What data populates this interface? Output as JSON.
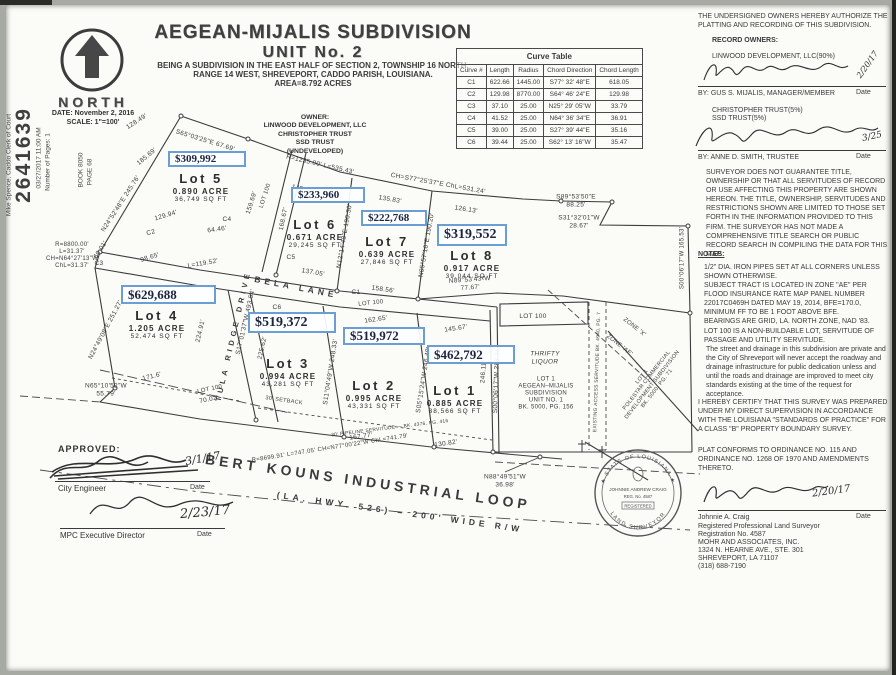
{
  "title": {
    "line1": "AEGEAN-MIJALIS SUBDIVISION",
    "line2": "UNIT No. 2",
    "line3": "BEING A SUBDIVISION IN THE EAST HALF OF SECTION 2, TOWNSHIP 16 NORTH,",
    "line4": "RANGE 14 WEST, SHREVEPORT, CADDO PARISH, LOUISIANA.",
    "line5": "AREA=8.792 ACRES"
  },
  "north": {
    "label": "NORTH",
    "date": "DATE: November 2, 2016",
    "scale": "SCALE: 1\"=100'"
  },
  "stamp": {
    "clerk": "Mike Spence, Caddo Clerk of Court",
    "number": "2641639",
    "filed": "03/27/2017 11:00 AM",
    "pages": "Number of Pages: 1",
    "book": "BOOK  8050",
    "page": "PAGE  68"
  },
  "owner_block": {
    "l1": "OWNER:",
    "l2": "LINWOOD DEVELOPMENT, LLC",
    "l3": "CHRISTOPHER TRUST",
    "l4": "SSD TRUST",
    "l5": "(UNDEVELOPED)"
  },
  "curve_table": {
    "title": "Curve Table",
    "headers": [
      "Curve #",
      "Length",
      "Radius",
      "Chord Direction",
      "Chord Length"
    ],
    "rows": [
      [
        "C1",
        "622.66",
        "1445.00",
        "S77° 32' 48\"E",
        "618.05"
      ],
      [
        "C2",
        "129.98",
        "8770.00",
        "S64° 46' 24\"E",
        "129.98"
      ],
      [
        "C3",
        "37.10",
        "25.00",
        "N25° 29' 05\"W",
        "33.79"
      ],
      [
        "C4",
        "41.52",
        "25.00",
        "N64° 36' 34\"E",
        "36.91"
      ],
      [
        "C5",
        "39.00",
        "25.00",
        "S27° 39' 44\"E",
        "35.16"
      ],
      [
        "C6",
        "39.44",
        "25.00",
        "S62° 13' 16\"W",
        "35.47"
      ]
    ]
  },
  "right_panel": {
    "authorize": "THE UNDERSIGNED OWNERS HEREBY AUTHORIZE THE PLATTING AND RECORDING OF THIS SUBDIVISION.",
    "record_owners": "RECORD OWNERS:",
    "owner1": "LINWOOD DEVELOPMENT, LLC(90%)",
    "by1": "BY: GUS S. MIJALIS, MANAGER/MEMBER",
    "date1": "2/20/17",
    "owner2a": "CHRISTOPHER TRUST(5%)",
    "owner2b": "SSD TRUST(5%)",
    "by2": "BY: ANNE D. SMITH, TRUSTEE",
    "date2": "3/25",
    "date_label": "Date",
    "disclaimer": "SURVEYOR DOES NOT GUARANTEE TITLE, OWNERSHIP OR THAT ALL SERVITUDES OF RECORD OR USE AFFECTING THIS PROPERTY ARE SHOWN HEREON. THE TITLE, OWNERSHIP, SERVITUDES AND RESTRICTIONS SHOWN ARE LIMITED TO THOSE SET FORTH IN THE INFORMATION PROVIDED TO THIS FIRM. THE SURVEYOR HAS NOT MADE A COMPREHENSIVE TITLE SEARCH OR PUBLIC RECORD SEARCH IN COMPILING THE DATA FOR THIS MAP.",
    "notes_heading": "NOTES:",
    "notes": [
      "1/2\" DIA. IRON PIPES SET AT ALL CORNERS UNLESS SHOWN OTHERWISE.",
      "SUBJECT TRACT IS LOCATED IN ZONE \"AE\" PER FLOOD INSURANCE RATE MAP PANEL NUMBER 22017C0469H DATED MAY 19, 2014, BFE=170.0, MINIMUM FF TO BE 1 FOOT ABOVE BFE.",
      "BEARINGS ARE GRID, LA. NORTH ZONE, NAD '83.",
      "LOT 100 IS A NON-BUILDABLE LOT, SERVITUDE OF PASSAGE AND UTILITY SERVITUDE.",
      "The street and drainage in this subdivision are private and the City of Shreveport will never accept the roadway and drainage infrastructure for public dedication unless and until the roads and drainage are improved to meet city standards existing at the time of the request for acceptance."
    ],
    "certify": "I HEREBY CERTIFY THAT THIS SURVEY WAS PREPARED UNDER MY DIRECT SUPERVISION IN ACCORDANCE WITH THE LOUISIANA \"STANDARDS OF PRACTICE\" FOR A CLASS \"B\" PROPERTY BOUNDARY SURVEY.",
    "conforms": "PLAT CONFORMS TO ORDINANCE NO. 115 AND ORDINANCE NO. 1268 OF 1970 AND AMENDMENTS THERETO.",
    "surveyor_name": "Johnnie A. Craig",
    "surveyor_date": "2/20/17",
    "cred1": "Registered Professional Land Surveyor",
    "cred2": "Registration No. 4587",
    "cred3": "MOHR AND ASSOCIATES, INC.",
    "cred4": "1324 N. HEARNE AVE., STE. 301",
    "cred5": "SHREVEPORT, LA 71107",
    "cred6": "(318) 688-7190"
  },
  "approvals": {
    "heading": "APPROVED:",
    "rows": [
      {
        "role": "City Engineer",
        "date": "3/1/17",
        "date_label": "Date"
      },
      {
        "role": "MPC Executive Director",
        "date": "2/23/17",
        "date_label": "Date"
      }
    ]
  },
  "seal": {
    "top": "★ STATE OF LOUISIANA ★",
    "bottom": "LAND SURVEYOR",
    "name": "JOHNNIE ANDREW CRAIG",
    "reg": "REG. No. 4587",
    "registered": "REGISTERED"
  },
  "plat": {
    "lots": [
      {
        "name": "Lot 5",
        "acre": "0.890 ACRE",
        "sqft": "36,749 SQ FT",
        "price": "$309,992",
        "lx": 201,
        "ly": 171,
        "bx": 168,
        "by": 151,
        "bw": 78,
        "bh": 16,
        "fs": 11
      },
      {
        "name": "Lot 6",
        "acre": "0.671 ACRE",
        "sqft": "29,245 SQ FT",
        "price": "$233,960",
        "lx": 315,
        "ly": 217,
        "bx": 291,
        "by": 187,
        "bw": 74,
        "bh": 16,
        "fs": 11
      },
      {
        "name": "Lot 7",
        "acre": "0.639 ACRE",
        "sqft": "27,846 SQ FT",
        "price": "$222,768",
        "lx": 387,
        "ly": 234,
        "bx": 361,
        "by": 210,
        "bw": 66,
        "bh": 16,
        "fs": 11
      },
      {
        "name": "Lot 8",
        "acre": "0.917 ACRE",
        "sqft": "39,044 SQ FT",
        "price": "$319,552",
        "lx": 472,
        "ly": 248,
        "bx": 437,
        "by": 224,
        "bw": 70,
        "bh": 22,
        "fs": 14
      },
      {
        "name": "Lot 4",
        "acre": "1.205 ACRE",
        "sqft": "52,474 SQ FT",
        "price": "$629,688",
        "lx": 157,
        "ly": 308,
        "bx": 121,
        "by": 285,
        "bw": 95,
        "bh": 19,
        "fs": 13
      },
      {
        "name": "Lot 3",
        "acre": "0.994 ACRE",
        "sqft": "43,281 SQ FT",
        "price": "$519,372",
        "lx": 288,
        "ly": 356,
        "bx": 248,
        "by": 312,
        "bw": 88,
        "bh": 21,
        "fs": 14
      },
      {
        "name": "Lot 2",
        "acre": "0.995 ACRE",
        "sqft": "43,331 SQ FT",
        "price": "$519,972",
        "lx": 374,
        "ly": 378,
        "bx": 343,
        "by": 327,
        "bw": 82,
        "bh": 18,
        "fs": 13
      },
      {
        "name": "Lot 1",
        "acre": "0.885 ACRE",
        "sqft": "38,566 SQ FT",
        "price": "$462,792",
        "lx": 455,
        "ly": 383,
        "bx": 427,
        "by": 345,
        "bw": 88,
        "bh": 19,
        "fs": 13
      }
    ],
    "labels": [
      {
        "t": "S65°03'25\"E  67.69'",
        "x": 205,
        "y": 141,
        "r": 17
      },
      {
        "t": "128.49'",
        "x": 137,
        "y": 122,
        "r": -33
      },
      {
        "t": "185.69'",
        "x": 147,
        "y": 157,
        "r": -40
      },
      {
        "t": "N24°52'48\"E  245.76'",
        "x": 121,
        "y": 204,
        "r": -57
      },
      {
        "t": "129.94'",
        "x": 166,
        "y": 216,
        "r": -17
      },
      {
        "t": "C2",
        "x": 151,
        "y": 233,
        "r": -15
      },
      {
        "t": "64.46'",
        "x": 217,
        "y": 230,
        "r": -8
      },
      {
        "t": "C4",
        "x": 227,
        "y": 220
      },
      {
        "t": "159.69'",
        "x": 252,
        "y": 203,
        "r": -72
      },
      {
        "t": "LOT 100",
        "x": 266,
        "y": 196,
        "r": -72,
        "s": 6
      },
      {
        "t": "60.01'",
        "x": 101,
        "y": 250,
        "r": -57
      },
      {
        "t": "98.65'",
        "x": 150,
        "y": 258,
        "r": -17
      },
      {
        "t": "L=119.52'",
        "x": 203,
        "y": 264,
        "r": -10
      },
      {
        "t": "R=1235.00'  L=535.43'",
        "x": 320,
        "y": 165,
        "r": 13
      },
      {
        "t": "CH=S77°25'37\"E  ChL=531.24'",
        "x": 438,
        "y": 184,
        "r": 10
      },
      {
        "t": "145.36'",
        "x": 303,
        "y": 190,
        "r": 13
      },
      {
        "t": "135.83'",
        "x": 390,
        "y": 200,
        "r": 10
      },
      {
        "t": "126.13'",
        "x": 466,
        "y": 210,
        "r": 9
      },
      {
        "t": "168.67'",
        "x": 284,
        "y": 219,
        "r": -78
      },
      {
        "t": "N12°14'48\"E  190.30'",
        "x": 345,
        "y": 236,
        "r": -80
      },
      {
        "t": "N05°57'16\"E  190.20'",
        "x": 427,
        "y": 245,
        "r": -80
      },
      {
        "t": "C5",
        "x": 291,
        "y": 258
      },
      {
        "t": "137.05'",
        "x": 313,
        "y": 273,
        "r": 10
      },
      {
        "t": "158.56'",
        "x": 383,
        "y": 290,
        "r": 8
      },
      {
        "t": "C1",
        "x": 356,
        "y": 293
      },
      {
        "t": "S89°53'50\"E\n88.25'",
        "x": 576,
        "y": 201
      },
      {
        "t": "S31°32'01\"W\n28.67'",
        "x": 579,
        "y": 222
      },
      {
        "t": "S00°06'17\"W  165.53'",
        "x": 683,
        "y": 258,
        "r": -90,
        "s": 6
      },
      {
        "t": "N89°53'43\"W\n77.67'",
        "x": 470,
        "y": 284,
        "r": -4
      },
      {
        "t": "R=8800.00'\nL=31.37'\nCH=N64°27'13\"W\nChL=31.37'",
        "x": 72,
        "y": 256,
        "s": 6
      },
      {
        "t": "C3",
        "x": 99,
        "y": 264
      },
      {
        "t": "N24°49'08\"E  251.27'",
        "x": 106,
        "y": 330,
        "r": -62
      },
      {
        "t": "224.91'",
        "x": 201,
        "y": 331,
        "r": -77
      },
      {
        "t": "S17°01'37\"W  493.54'",
        "x": 246,
        "y": 322,
        "r": -77
      },
      {
        "t": "225.62'",
        "x": 263,
        "y": 348,
        "r": -77
      },
      {
        "t": "C6",
        "x": 277,
        "y": 308
      },
      {
        "t": "171.6'",
        "x": 152,
        "y": 377,
        "r": -14
      },
      {
        "t": "N65°10'52\"W\n55.79'",
        "x": 106,
        "y": 390
      },
      {
        "t": "LOT 100",
        "x": 210,
        "y": 390,
        "r": -12,
        "s": 6
      },
      {
        "t": "70.02'",
        "x": 209,
        "y": 400,
        "r": -12
      },
      {
        "t": "30' SETBACK",
        "x": 284,
        "y": 401,
        "r": 8,
        "s": 5.5
      },
      {
        "t": "LOT 100",
        "x": 371,
        "y": 304,
        "r": -6,
        "s": 6
      },
      {
        "t": "162.65'",
        "x": 376,
        "y": 320,
        "r": -8
      },
      {
        "t": "145.67'",
        "x": 456,
        "y": 329,
        "r": -8
      },
      {
        "t": "S11°04'49\"W  248.33'",
        "x": 331,
        "y": 372,
        "r": -81
      },
      {
        "t": "S05°15'24\"W  246.48'",
        "x": 424,
        "y": 380,
        "r": -81
      },
      {
        "t": "246.11'",
        "x": 484,
        "y": 372,
        "r": -86
      },
      {
        "t": "S00°06'17\"W  298.11'",
        "x": 497,
        "y": 380,
        "r": -88
      },
      {
        "t": "30' PIPELINE SERVITUDE — BK. 4376, PG. 416",
        "x": 390,
        "y": 429,
        "r": -7,
        "s": 4.8
      },
      {
        "t": "167.77'",
        "x": 361,
        "y": 437,
        "r": -8
      },
      {
        "t": "130.82'",
        "x": 446,
        "y": 444,
        "r": -8
      },
      {
        "t": "R=8699.91'  L=747.05'  CH=N77°00'22\"W  ChL=741.79'",
        "x": 330,
        "y": 449,
        "r": -9,
        "s": 6
      },
      {
        "t": "N88°49'51\"W\n36.98'",
        "x": 505,
        "y": 481
      },
      {
        "t": "LOT 100",
        "x": 533,
        "y": 317
      },
      {
        "t": "THRIFTY\nLIQUOR",
        "x": 545,
        "y": 358,
        "i": 1
      },
      {
        "t": "LOT 1\nAEGEAN–MIJALIS\nSUBDIVISION\nUNIT NO. 1\nBK. 5000, PG. 156",
        "x": 546,
        "y": 394,
        "s": 6
      },
      {
        "t": "EXISTING ACCESS SERVITUDE BK. 4940, PG. 7",
        "x": 598,
        "y": 372,
        "r": -88,
        "s": 4.8
      },
      {
        "t": "ZONE 'X'",
        "x": 634,
        "y": 328,
        "r": 38,
        "s": 6
      },
      {
        "t": "ZONE 'AE'",
        "x": 619,
        "y": 346,
        "r": 38,
        "s": 6
      },
      {
        "t": "LOT 1\nPOLESTAR COMMERCIAL\nDEVELOPMENT SUBDIVISION\nBK. 5000, PG. 71",
        "x": 650,
        "y": 383,
        "r": -52,
        "s": 5.5
      },
      {
        "t": "BELA LANE",
        "x": 296,
        "y": 287,
        "r": 11,
        "s": 8.5,
        "street": 1
      },
      {
        "t": "TULA RIDGE DRIVE",
        "x": 234,
        "y": 336,
        "r": -77,
        "s": 7.5,
        "street": 1
      },
      {
        "t": "BERT KOUNS INDUSTRIAL LOOP",
        "x": 368,
        "y": 482,
        "r": 8,
        "s": 14,
        "street": 1
      },
      {
        "t": "(LA. HWY. 526) – 200' WIDE R/W",
        "x": 400,
        "y": 512,
        "r": 8,
        "s": 8.5,
        "street": 1
      }
    ]
  }
}
